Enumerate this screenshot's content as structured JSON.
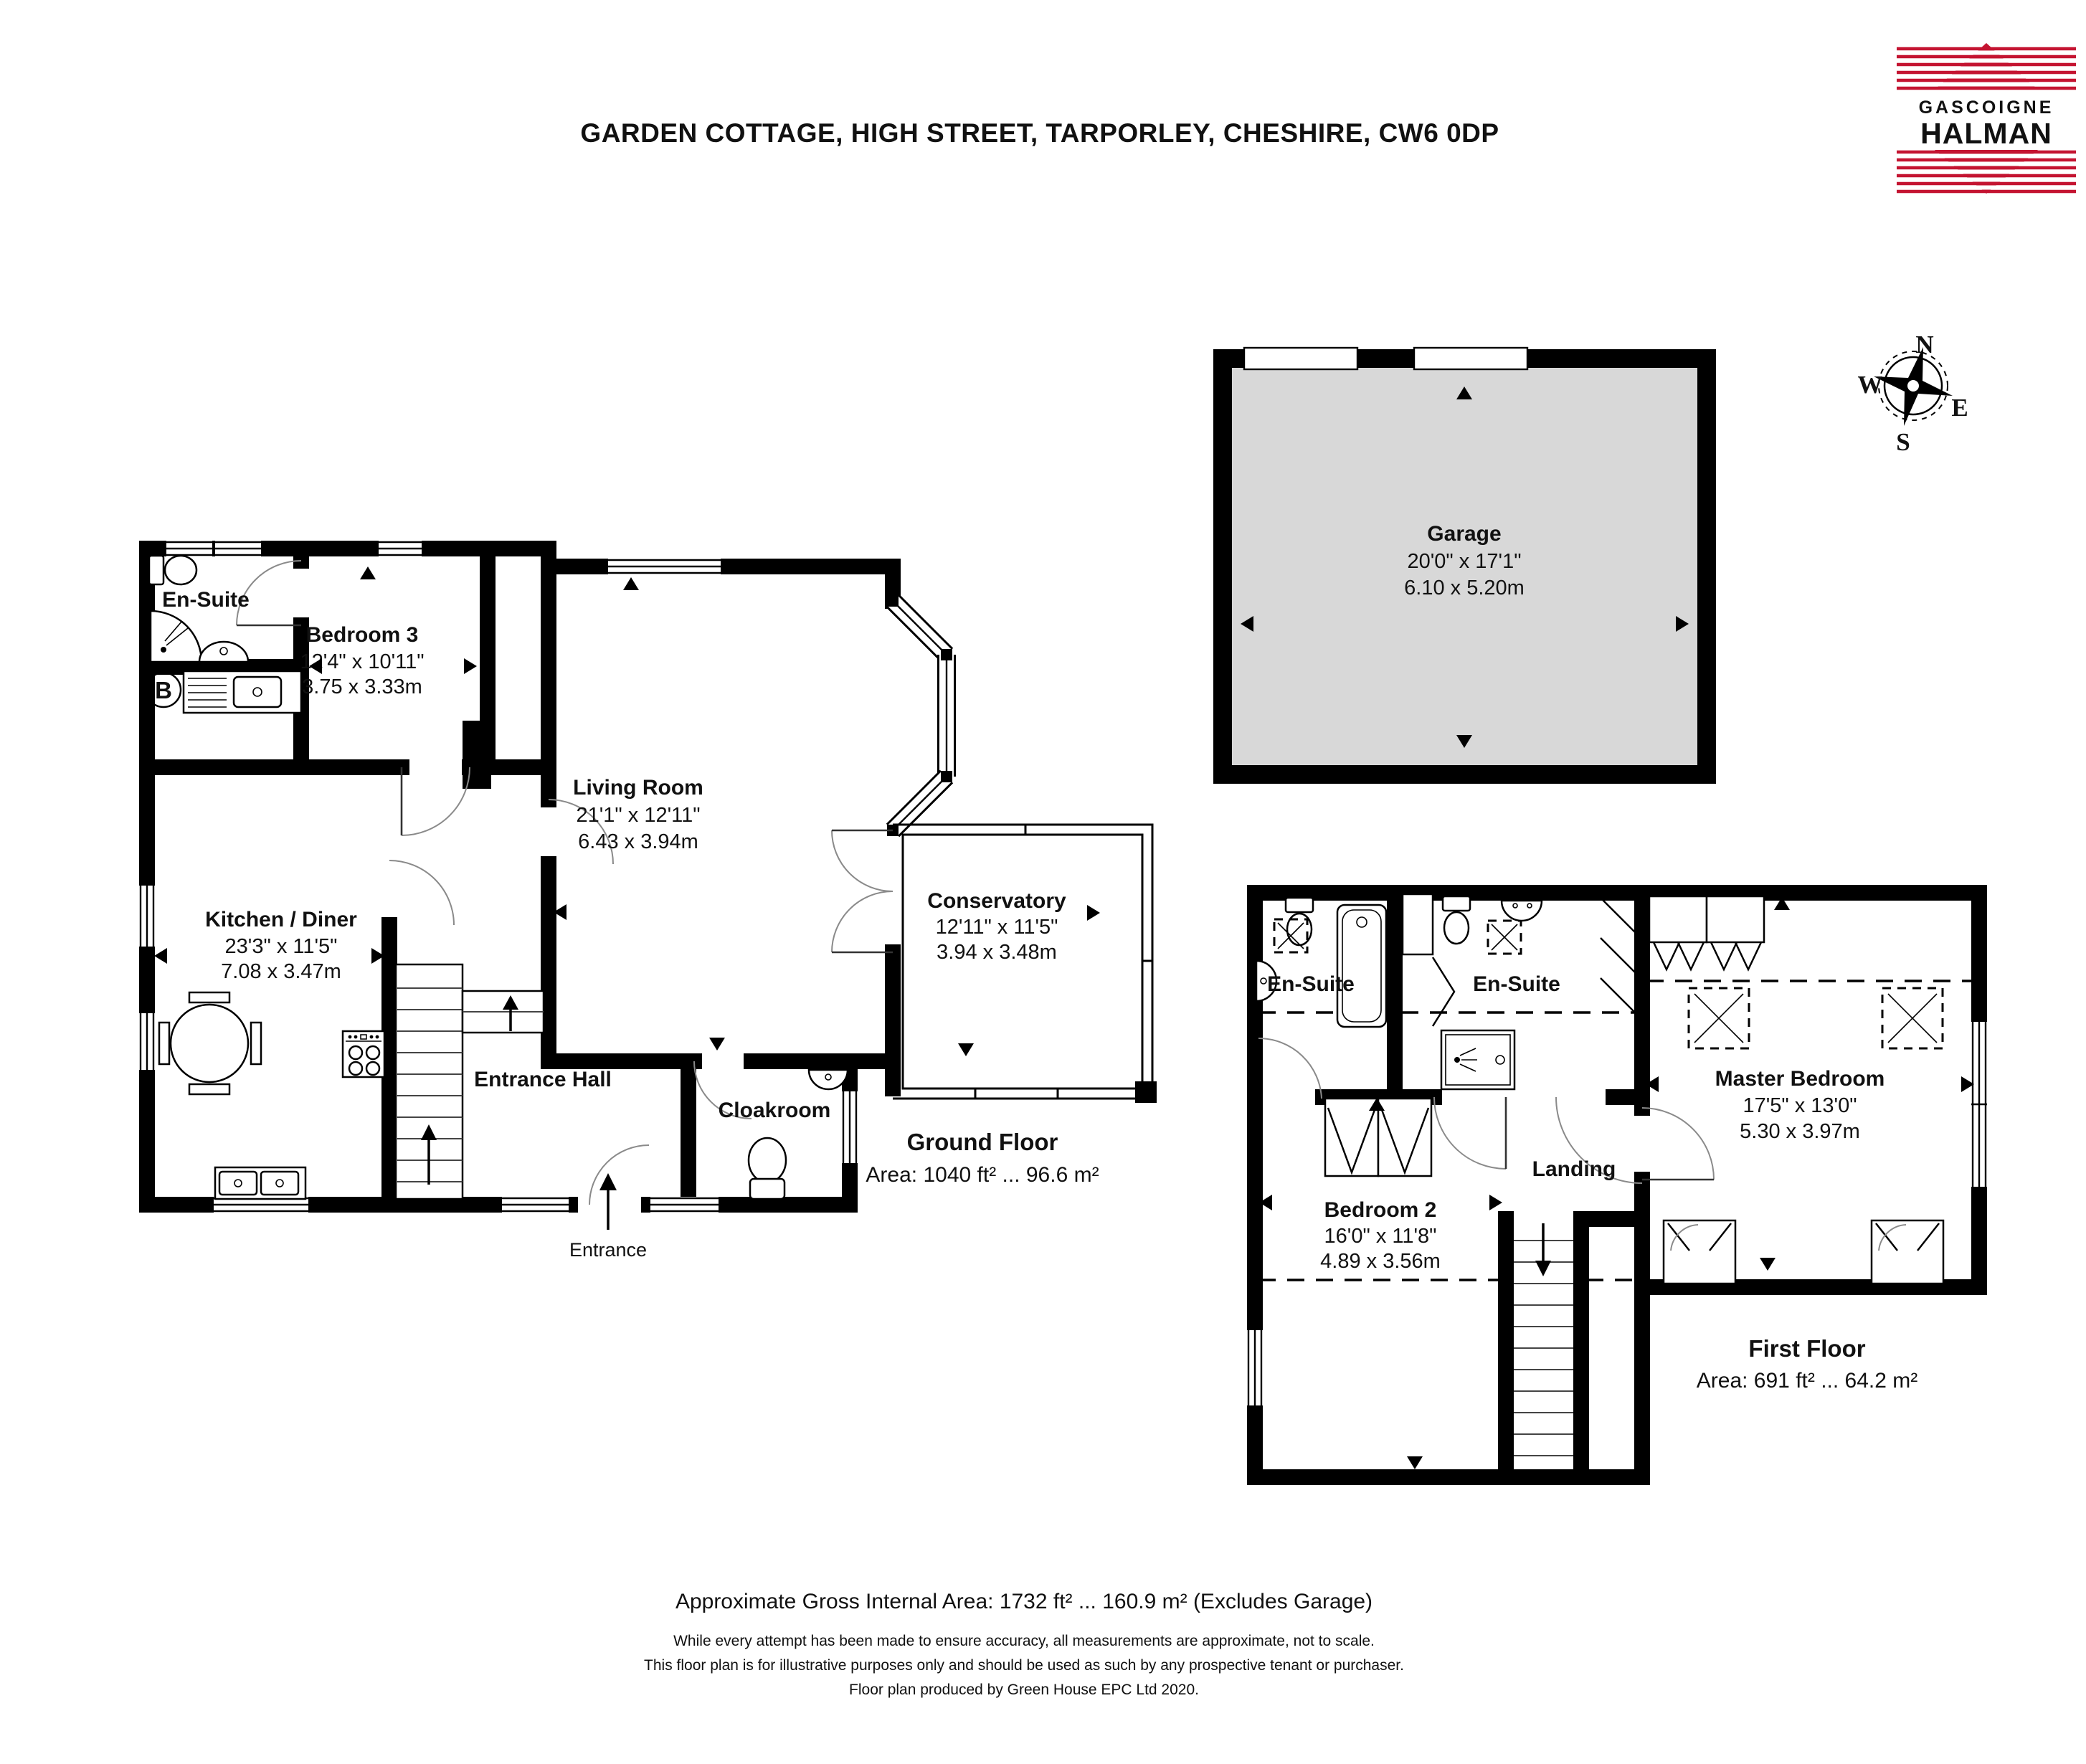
{
  "page": {
    "title": "GARDEN COTTAGE, HIGH STREET, TARPORLEY, CHESHIRE, CW6 0DP"
  },
  "logo": {
    "line1": "GASCOIGNE",
    "line2": "HALMAN"
  },
  "compass": {
    "north": "N",
    "south": "S",
    "east": "E",
    "west": "W"
  },
  "colors": {
    "wall": "#000000",
    "garage_fill": "#D8D8D8",
    "logo_red": "#C41431",
    "text": "#111111"
  },
  "floors": {
    "ground": {
      "name": "Ground Floor",
      "area": "Area: 1040 ft² ... 96.6 m²",
      "rooms": {
        "ensuite": {
          "name": "En-Suite"
        },
        "bedroom3": {
          "name": "Bedroom 3",
          "imperial": "12'4\" x 10'11\"",
          "metric": "3.75 x 3.33m"
        },
        "kitchen": {
          "name": "Kitchen / Diner",
          "imperial": "23'3\" x 11'5\"",
          "metric": "7.08 x 3.47m"
        },
        "living": {
          "name": "Living Room",
          "imperial": "21'1\" x 12'11\"",
          "metric": "6.43 x 3.94m"
        },
        "conservatory": {
          "name": "Conservatory",
          "imperial": "12'11\" x 11'5\"",
          "metric": "3.94 x 3.48m"
        },
        "entrance_hall": {
          "name": "Entrance Hall"
        },
        "cloakroom": {
          "name": "Cloakroom"
        },
        "entrance": {
          "name": "Entrance"
        },
        "boiler": {
          "label": "B"
        }
      }
    },
    "first": {
      "name": "First Floor",
      "area": "Area: 691 ft² ... 64.2 m²",
      "rooms": {
        "ensuite1": {
          "name": "En-Suite"
        },
        "ensuite2": {
          "name": "En-Suite"
        },
        "master": {
          "name": "Master Bedroom",
          "imperial": "17'5\" x 13'0\"",
          "metric": "5.30 x 3.97m"
        },
        "bedroom2": {
          "name": "Bedroom 2",
          "imperial": "16'0\" x 11'8\"",
          "metric": "4.89 x 3.56m"
        },
        "landing": {
          "name": "Landing"
        }
      }
    },
    "garage": {
      "name": "Garage",
      "imperial": "20'0\" x 17'1\"",
      "metric": "6.10 x 5.20m"
    }
  },
  "footer": {
    "gross_area": "Approximate Gross Internal Area: 1732 ft² ... 160.9 m² (Excludes Garage)",
    "disclaimer1": "While every attempt has been made to ensure accuracy, all measurements are approximate, not to scale.",
    "disclaimer2": "This floor plan is for illustrative purposes only and should be used as such by any prospective tenant or purchaser.",
    "disclaimer3": "Floor plan produced by Green House EPC Ltd 2020."
  }
}
